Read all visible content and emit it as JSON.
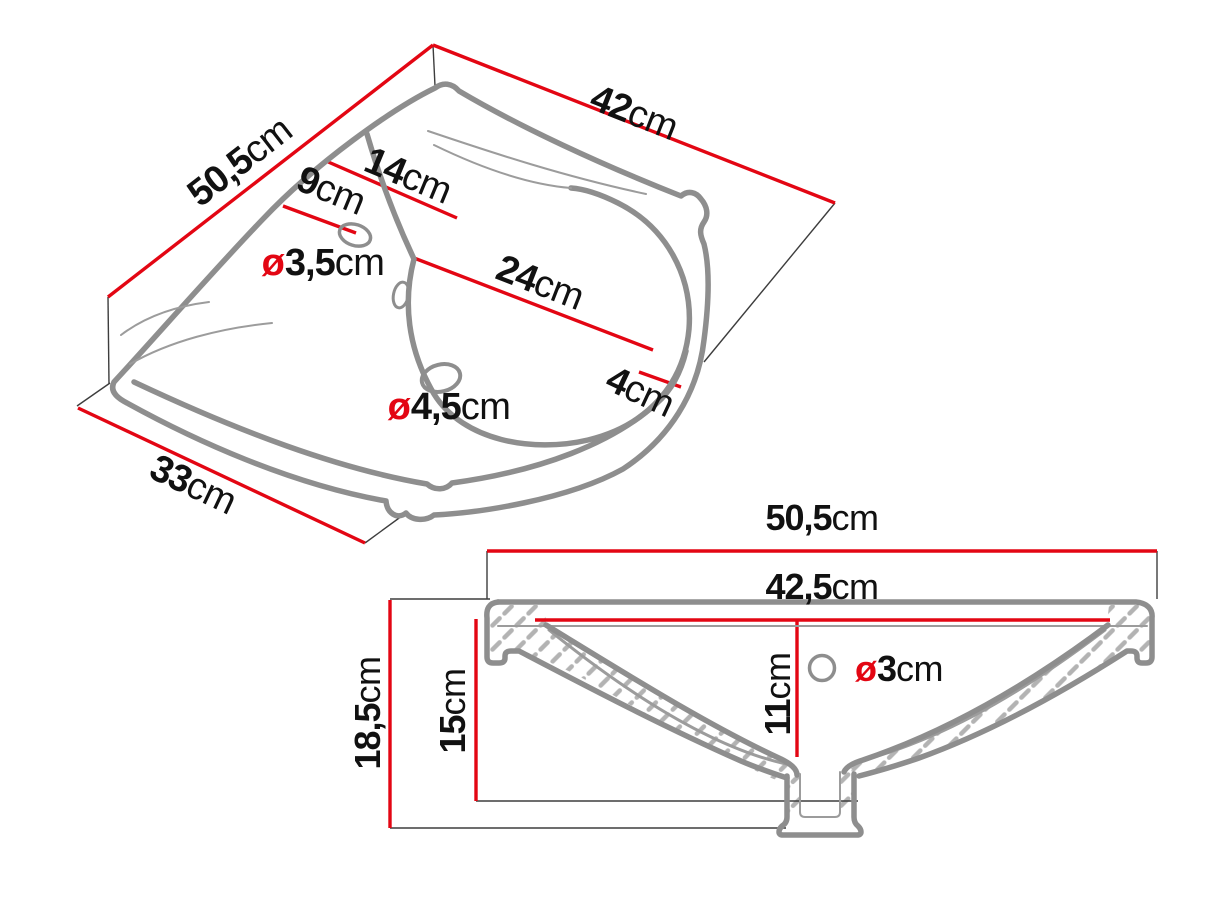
{
  "diagram": {
    "type": "washbasin technical drawing",
    "colors": {
      "dimension_red": "#e30613",
      "outline_gray": "#8e8e8e",
      "hatch_gray": "#b3b3b3",
      "text_black": "#111111"
    },
    "top_view": {
      "dims": {
        "d50_5": {
          "value": "50,5",
          "unit": "cm"
        },
        "d42": {
          "value": "42",
          "unit": "cm"
        },
        "d33": {
          "value": "33",
          "unit": "cm"
        },
        "d14": {
          "value": "14",
          "unit": "cm"
        },
        "d9": {
          "value": "9",
          "unit": "cm"
        },
        "d24": {
          "value": "24",
          "unit": "cm"
        },
        "d4": {
          "value": "4",
          "unit": "cm"
        },
        "d3_5": {
          "prefix": "ø",
          "value": "3,5",
          "unit": "cm"
        },
        "d4_5": {
          "prefix": "ø",
          "value": "4,5",
          "unit": "cm"
        }
      }
    },
    "section_view": {
      "dims": {
        "d50_5": {
          "value": "50,5",
          "unit": "cm"
        },
        "d42_5": {
          "value": "42,5",
          "unit": "cm"
        },
        "d18_5": {
          "value": "18,5",
          "unit": "cm"
        },
        "d15": {
          "value": "15",
          "unit": "cm"
        },
        "d11": {
          "value": "11",
          "unit": "cm"
        },
        "d3": {
          "prefix": "ø",
          "value": "3",
          "unit": "cm"
        }
      }
    }
  }
}
